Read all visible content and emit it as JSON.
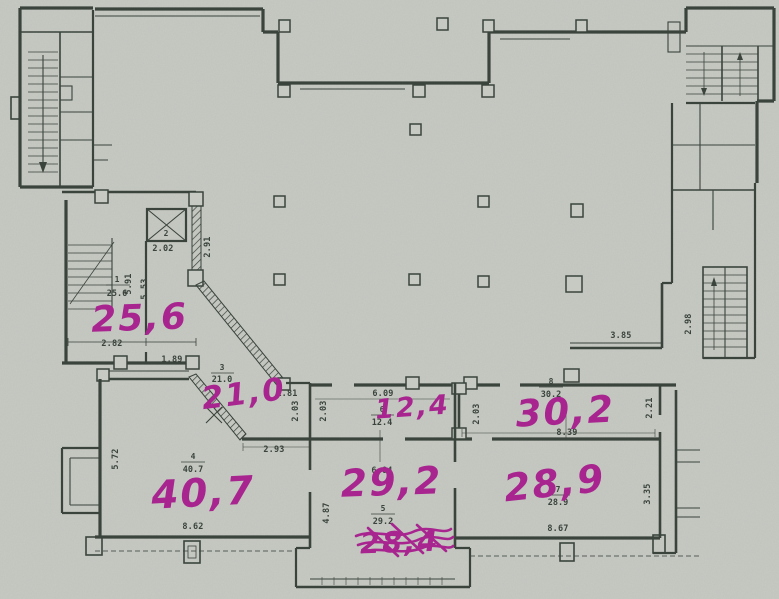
{
  "rooms": {
    "r1": {
      "number": "1",
      "area": "25.6",
      "handwritten": "25,6"
    },
    "r2": {
      "number": "2"
    },
    "r3": {
      "number": "3",
      "area": "21.0",
      "handwritten": "21,0"
    },
    "r4": {
      "number": "4",
      "area": "40.7",
      "handwritten": "40,7"
    },
    "r5": {
      "number": "5",
      "area": "29.2",
      "handwritten": "29,2"
    },
    "r6": {
      "number": "6",
      "area": "12.4",
      "handwritten": "12,4"
    },
    "r7": {
      "number": "7",
      "area": "28.9",
      "handwritten": "28,9"
    },
    "r8": {
      "number": "8",
      "area": "30.2",
      "handwritten": "30,2"
    }
  },
  "annotations": {
    "crossed_out": "28,4"
  },
  "dims": {
    "elevator_width": "2.02",
    "lobby_wall": "2.91",
    "room1_depth_a": "5.91",
    "room1_depth_b": "5.53",
    "room1_width_a": "2.82",
    "room1_width_b": "1.89",
    "corridor_width": "1.81",
    "corridor_wall_a": "2.03",
    "corridor_wall_b": "2.03",
    "room4_top": "2.93",
    "room6_width": "6.09",
    "room5_width": "6.04",
    "room5_depth": "4.87",
    "room4_left": "5.72",
    "room4_bottom": "8.62",
    "room8_width": "8.39",
    "room8_left": "2.03",
    "room8_right": "2.21",
    "room7_right": "3.35",
    "room7_bottom": "8.67",
    "hall_niche": "3.85",
    "hall_shaft": "2.98"
  },
  "colors": {
    "paper": "#c7cac3",
    "ink": "#3a443d",
    "marker": "#a82590"
  }
}
